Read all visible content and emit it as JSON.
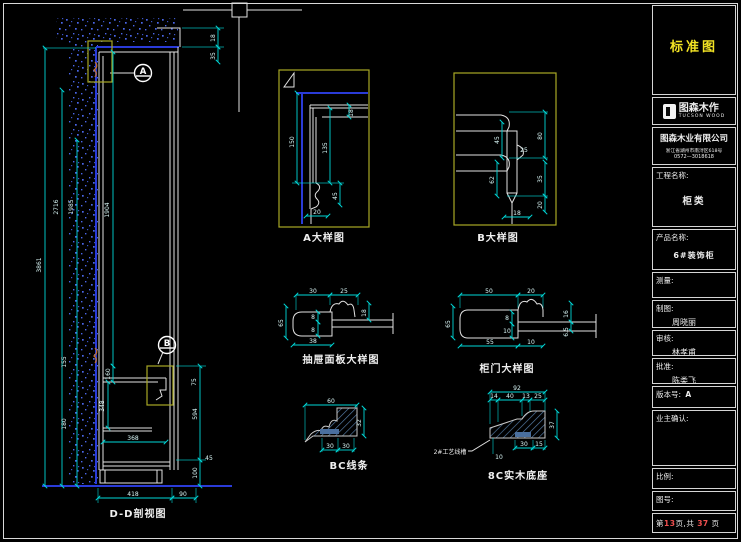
{
  "colors": {
    "background": "#000000",
    "line_white": "#e2e2e2",
    "dimension_cyan": "#00d8d8",
    "wall_blue": "#2a3bd8",
    "speckle_blue": "#4a66e8",
    "highlight_olive": "#a8a826",
    "hatch_blue": "#567da8",
    "standard_yellow": "#f2e324",
    "page_number_red": "#f05050"
  },
  "drawings": {
    "section": {
      "caption": "D-D剖视图",
      "callouts": [
        "A",
        "B"
      ],
      "dims": [
        "3861",
        "2716",
        "1985",
        "1904",
        "18",
        "35",
        "160",
        "348",
        "368",
        "418",
        "90",
        "75",
        "594",
        "100",
        "45",
        "155",
        "180"
      ]
    },
    "detail_a": {
      "caption": "A大样图",
      "dims": [
        "150",
        "135",
        "18",
        "45",
        "20"
      ]
    },
    "detail_b": {
      "caption": "B大样图",
      "dims": [
        "45",
        "80",
        "25",
        "62",
        "35",
        "20",
        "18"
      ]
    },
    "drawer_panel": {
      "caption": "抽屉面板大样图",
      "dims": [
        "30",
        "25",
        "65",
        "8",
        "8",
        "18",
        "38"
      ]
    },
    "cabinet_door": {
      "caption": "柜门大样图",
      "dims": [
        "50",
        "20",
        "65",
        "8",
        "10",
        "16",
        "6.5",
        "55",
        "10"
      ]
    },
    "bc_moulding": {
      "caption": "BC线条",
      "dims": [
        "60",
        "32",
        "30",
        "30"
      ]
    },
    "base_8c": {
      "caption": "8C实木底座",
      "leader_label": "2#工艺线槽",
      "dims": [
        "92",
        "14",
        "40",
        "13",
        "25",
        "37",
        "30",
        "15",
        "10"
      ]
    }
  },
  "title_block": {
    "standard_label": "标准图",
    "logo": {
      "brand": "图森木作",
      "brand_en": "TUCSON WOOD"
    },
    "company": {
      "name": "图森木业有限公司",
      "address": "浙江省湖州市南浔区618号",
      "phone": "0572—3018618"
    },
    "fields": {
      "project_label": "工程名称:",
      "project_value": "柜类",
      "product_label": "产品名称:",
      "product_value": "6#装饰柜",
      "measure_label": "测量:",
      "draft_label": "制图:",
      "draft_value": "周晓丽",
      "review_label": "审核:",
      "review_value": "林孝甫",
      "approve_label": "批准:",
      "approve_value": "陈类飞",
      "version_label": "版本号:",
      "version_value": "A",
      "owner_label": "业主确认:",
      "scale_label": "比例:",
      "drawing_no_label": "图号:",
      "page": {
        "prefix": "第",
        "current": "13",
        "middle": "页,共",
        "total": "37",
        "suffix": "页"
      }
    }
  }
}
